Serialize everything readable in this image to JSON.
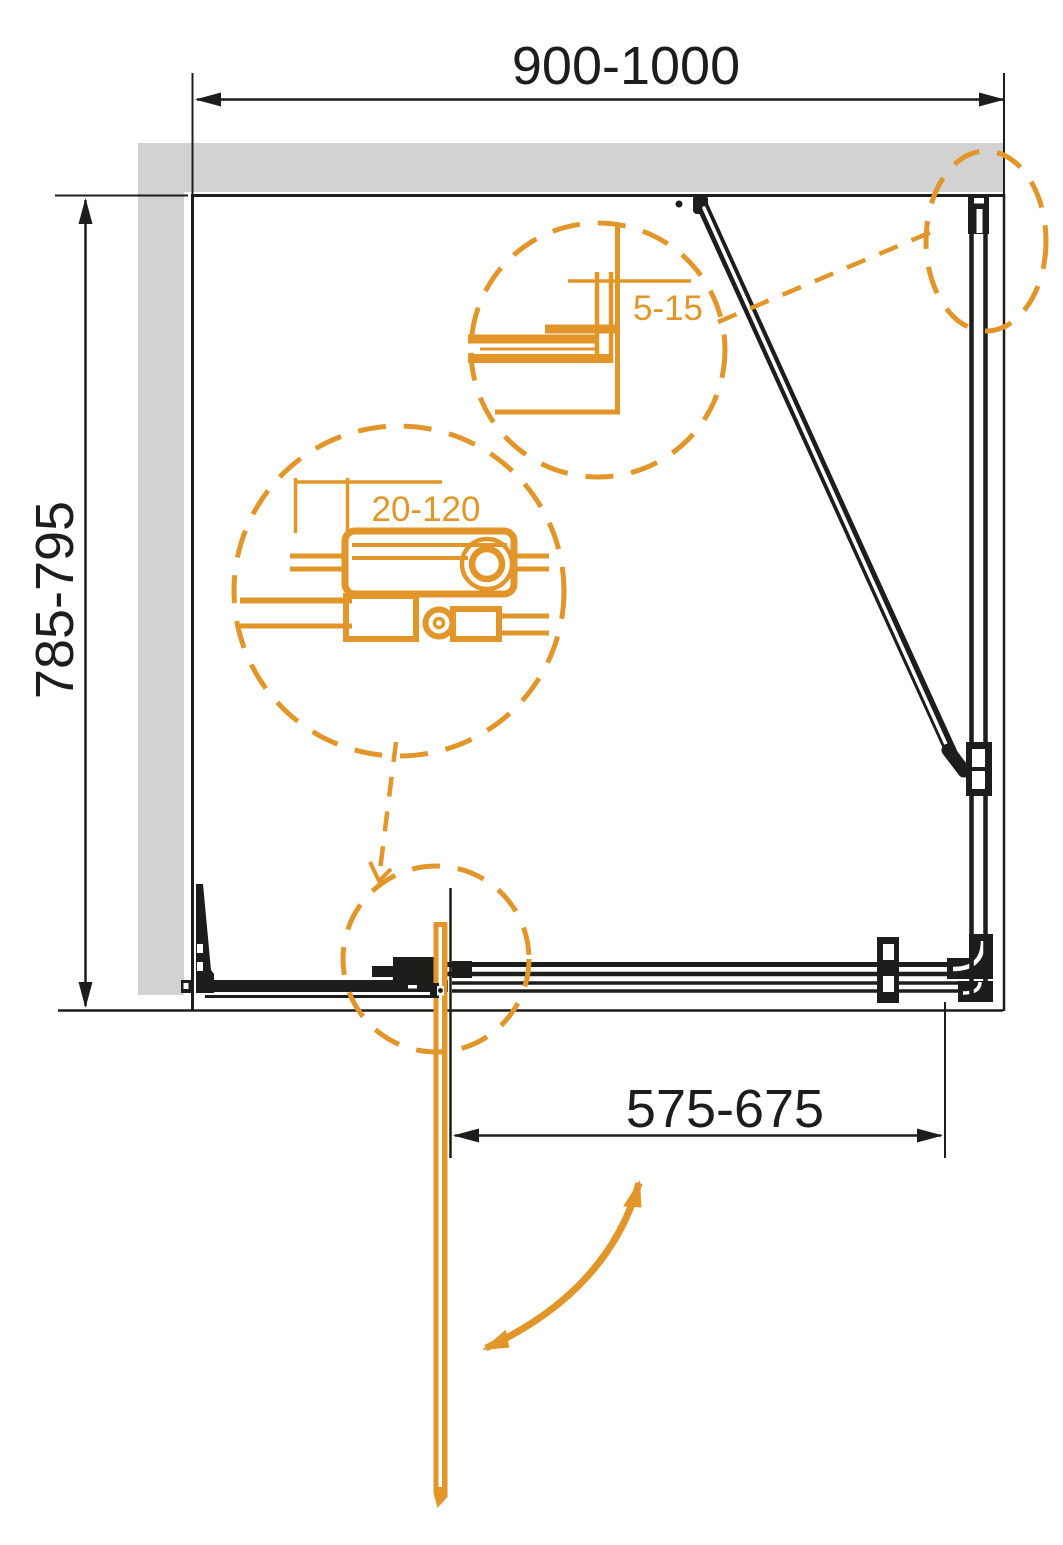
{
  "drawing": {
    "labels": {
      "width_range": "900-1000",
      "depth_range": "785-795",
      "door_width_range": "575-675",
      "profile_adjust_range": "5-15",
      "bracket_adjust_range": "20-120"
    },
    "colors": {
      "line": "#1D1D1B",
      "wall": "#D2D2D2",
      "accent": "#E2962A",
      "background": "#FFFFFF"
    }
  }
}
